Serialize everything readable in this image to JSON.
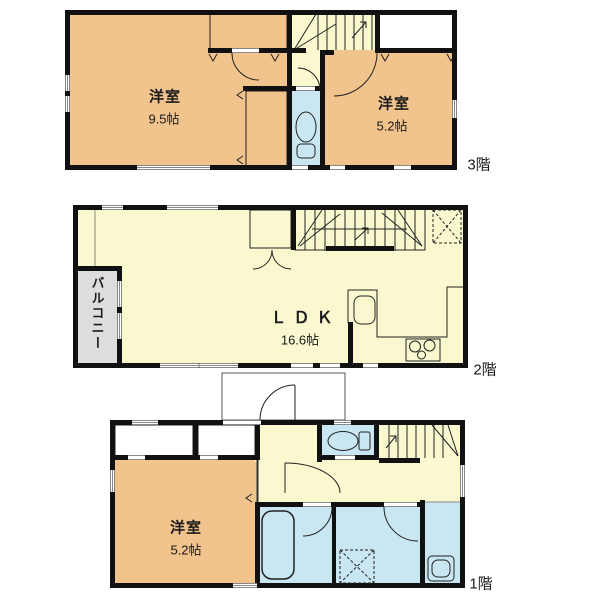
{
  "title": "3-story house floor plan",
  "colors": {
    "room_orange": "#F1C38D",
    "area_yellow": "#FAF8CF",
    "water_blue": "#C9E6F3",
    "closet_gray": "#DDDDDD",
    "wall": "#111111",
    "bg": "#FFFFFF"
  },
  "floors": [
    {
      "label": "3階",
      "rooms": [
        {
          "name": "洋室",
          "size": "9.5帖"
        },
        {
          "name": "洋室",
          "size": "5.2帖"
        }
      ]
    },
    {
      "label": "2階",
      "rooms": [
        {
          "name": "ＬＤＫ",
          "size": "16.6帖"
        },
        {
          "name": "バルコニー",
          "size": ""
        }
      ]
    },
    {
      "label": "1階",
      "rooms": [
        {
          "name": "洋室",
          "size": "5.2帖"
        }
      ]
    }
  ],
  "icons": {
    "toilet": "toilet-icon",
    "bathtub": "bathtub-icon",
    "kitchen_sink": "kitchen-sink-icon",
    "stove": "stove-icon",
    "washing_machine_pan": "washing-machine-pan-icon",
    "skylight": "skylight-icon",
    "stairs": "stairs-icon",
    "door_swing": "door-swing-arc"
  }
}
